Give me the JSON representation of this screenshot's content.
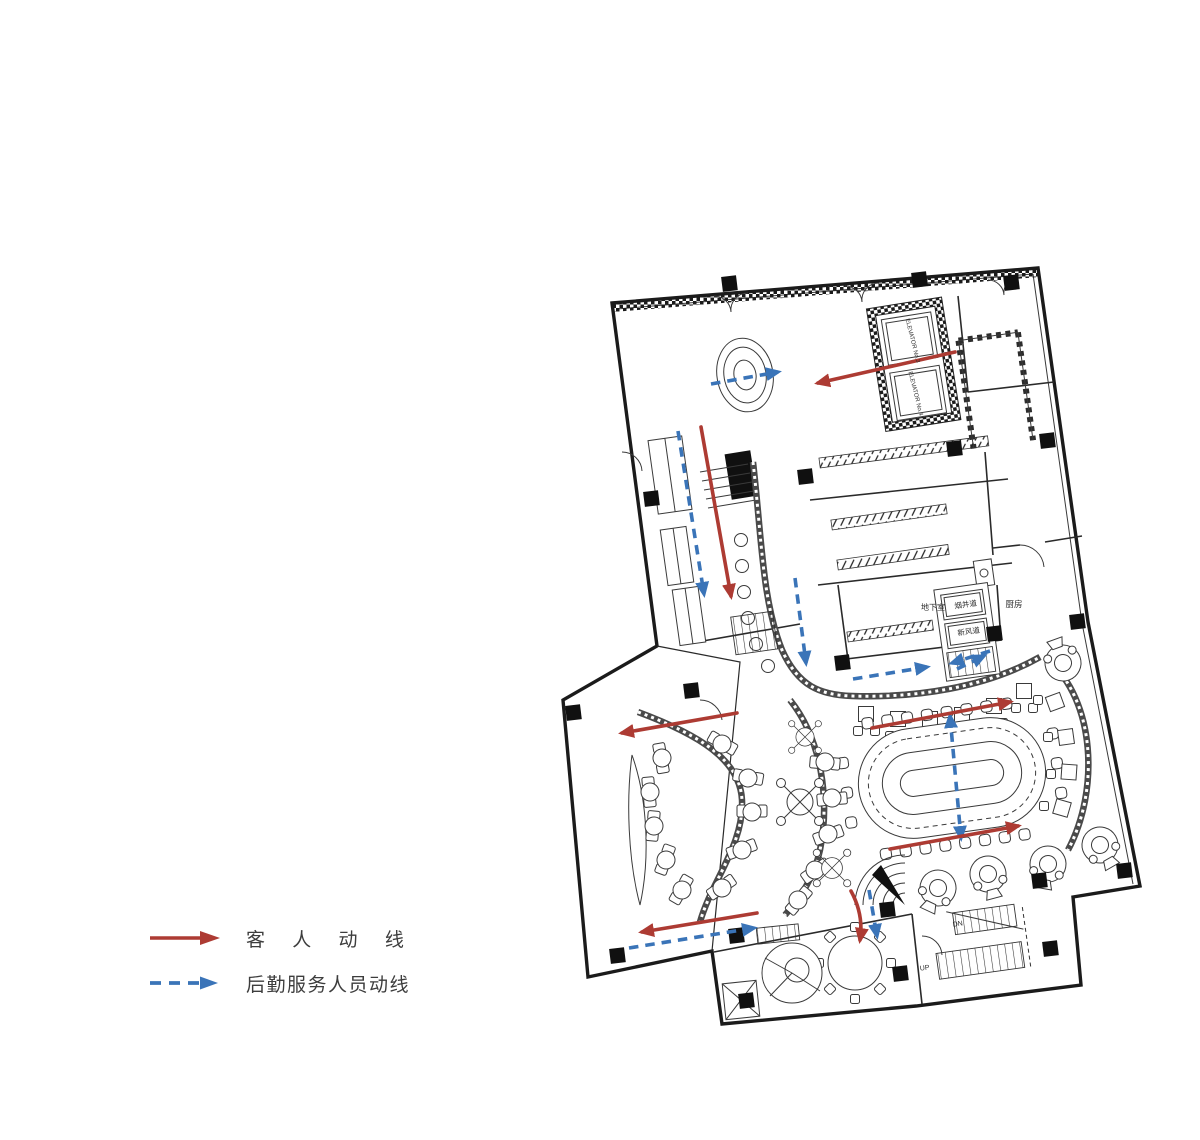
{
  "legend": {
    "items": [
      {
        "id": "guest",
        "label": "客  人  动  线",
        "color": "#ad3b33",
        "line_style": "solid",
        "icon": "solid-right-arrow"
      },
      {
        "id": "service",
        "label": "后勤服务人员动线",
        "color": "#3a74b8",
        "line_style": "dashed",
        "icon": "dashed-right-arrow"
      }
    ]
  },
  "plan": {
    "labels": {
      "elevator3": "ELEVATOR No.3",
      "elevator4": "ELEVATOR No.4",
      "basement": "地下室",
      "smoke_shaft": "烟井道",
      "fresh_air": "新风道",
      "kitchen": "厨房",
      "stair_dn": "DN",
      "stair_up": "UP"
    },
    "colors": {
      "guest_flow": "#ad3b33",
      "service_flow": "#3a74b8",
      "wall": "#1b1b1b"
    },
    "arrows": {
      "guest": [
        {
          "d": "M955,352 L818,383"
        },
        {
          "d": "M701,427 L731,596"
        },
        {
          "d": "M737,713 L622,733"
        },
        {
          "d": "M872,728 L1010,702"
        },
        {
          "d": "M890,849 L1018,826"
        },
        {
          "d": "M757,913 L642,932"
        },
        {
          "d": "M851,891 Q864,915 860,940"
        }
      ],
      "service": [
        {
          "d": "M711,384 L778,372"
        },
        {
          "d": "M678,431 L704,594"
        },
        {
          "d": "M795,578 L806,663"
        },
        {
          "d": "M853,679 L927,667"
        },
        {
          "d": "M990,651 L952,663"
        },
        {
          "d": "M957,669 L984,656"
        },
        {
          "d": "M950,716 L961,838",
          "heads": "both"
        },
        {
          "d": "M629,948 L754,928"
        },
        {
          "d": "M869,890 L877,936"
        }
      ]
    }
  }
}
